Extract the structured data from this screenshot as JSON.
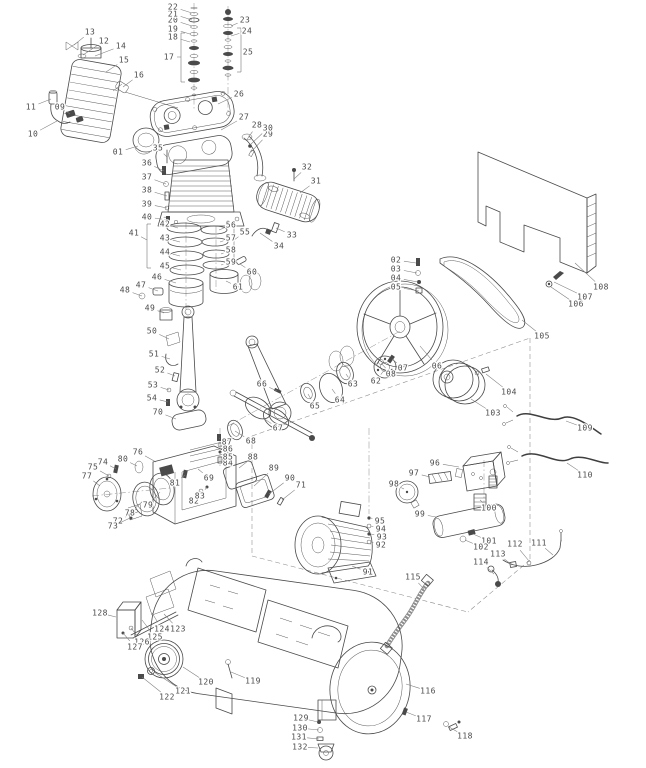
{
  "figure": {
    "type": "exploded-parts-diagram",
    "subject": "belt-driven air compressor assembly",
    "background_color": "#ffffff",
    "line_color": "#4a4a4a",
    "label_color": "#4a4a4a"
  },
  "labels": [
    {
      "n": "01",
      "x": 118,
      "y": 152,
      "tx": 138,
      "ty": 146
    },
    {
      "n": "02",
      "x": 396,
      "y": 260,
      "tx": 416,
      "ty": 263
    },
    {
      "n": "03",
      "x": 396,
      "y": 269,
      "tx": 417,
      "ty": 273
    },
    {
      "n": "04",
      "x": 396,
      "y": 278,
      "tx": 418,
      "ty": 282
    },
    {
      "n": "05",
      "x": 396,
      "y": 287,
      "tx": 419,
      "ty": 291
    },
    {
      "n": "06",
      "x": 437,
      "y": 366,
      "tx": 420,
      "ty": 346
    },
    {
      "n": "07",
      "x": 403,
      "y": 368,
      "tx": 392,
      "ty": 359
    },
    {
      "n": "08",
      "x": 391,
      "y": 374,
      "tx": 381,
      "ty": 363
    },
    {
      "n": "09",
      "x": 60,
      "y": 107,
      "tx": 70,
      "ty": 114
    },
    {
      "n": "10",
      "x": 33,
      "y": 134,
      "tx": 57,
      "ty": 121
    },
    {
      "n": "11",
      "x": 31,
      "y": 107,
      "tx": 51,
      "ty": 99
    },
    {
      "n": "12",
      "x": 104,
      "y": 41,
      "tx": 83,
      "ty": 55
    },
    {
      "n": "13",
      "x": 90,
      "y": 32,
      "tx": 74,
      "ty": 45
    },
    {
      "n": "14",
      "x": 121,
      "y": 46,
      "tx": 95,
      "ty": 56
    },
    {
      "n": "15",
      "x": 124,
      "y": 60,
      "tx": 106,
      "ty": 72
    },
    {
      "n": "16",
      "x": 139,
      "y": 75,
      "tx": 123,
      "ty": 87
    },
    {
      "n": "17",
      "x": 169,
      "y": 57,
      "tx": 181,
      "ty": 57
    },
    {
      "n": "18",
      "x": 173,
      "y": 37,
      "tx": 190,
      "ty": 42
    },
    {
      "n": "19",
      "x": 173,
      "y": 29,
      "tx": 190,
      "ty": 34
    },
    {
      "n": "20",
      "x": 173,
      "y": 20,
      "tx": 192,
      "ty": 26
    },
    {
      "n": "21",
      "x": 173,
      "y": 14,
      "tx": 192,
      "ty": 20
    },
    {
      "n": "22",
      "x": 173,
      "y": 7,
      "tx": 192,
      "ty": 13
    },
    {
      "n": "23",
      "x": 245,
      "y": 20,
      "tx": 231,
      "ty": 26
    },
    {
      "n": "24",
      "x": 247,
      "y": 31,
      "tx": 231,
      "ty": 36
    },
    {
      "n": "25",
      "x": 248,
      "y": 52,
      "tx": 241,
      "ty": 52
    },
    {
      "n": "26",
      "x": 239,
      "y": 94,
      "tx": 218,
      "ty": 104
    },
    {
      "n": "27",
      "x": 244,
      "y": 117,
      "tx": 221,
      "ty": 130
    },
    {
      "n": "28",
      "x": 257,
      "y": 125,
      "tx": 246,
      "ty": 141
    },
    {
      "n": "29",
      "x": 268,
      "y": 134,
      "tx": 251,
      "ty": 152
    },
    {
      "n": "30",
      "x": 268,
      "y": 128,
      "tx": 250,
      "ty": 145
    },
    {
      "n": "31",
      "x": 316,
      "y": 181,
      "tx": 300,
      "ty": 193
    },
    {
      "n": "32",
      "x": 307,
      "y": 167,
      "tx": 294,
      "ty": 179
    },
    {
      "n": "33",
      "x": 292,
      "y": 235,
      "tx": 276,
      "ty": 228
    },
    {
      "n": "34",
      "x": 279,
      "y": 246,
      "tx": 260,
      "ty": 233
    },
    {
      "n": "35",
      "x": 158,
      "y": 148,
      "tx": 167,
      "ty": 157
    },
    {
      "n": "36",
      "x": 147,
      "y": 163,
      "tx": 164,
      "ty": 171
    },
    {
      "n": "37",
      "x": 147,
      "y": 177,
      "tx": 166,
      "ty": 184
    },
    {
      "n": "38",
      "x": 147,
      "y": 190,
      "tx": 167,
      "ty": 196
    },
    {
      "n": "39",
      "x": 147,
      "y": 204,
      "tx": 167,
      "ty": 208
    },
    {
      "n": "40",
      "x": 147,
      "y": 217,
      "tx": 168,
      "ty": 220
    },
    {
      "n": "41",
      "x": 134,
      "y": 233,
      "tx": 147,
      "ty": 240
    },
    {
      "n": "42",
      "x": 165,
      "y": 224,
      "tx": 178,
      "ty": 228
    },
    {
      "n": "43",
      "x": 165,
      "y": 238,
      "tx": 180,
      "ty": 242
    },
    {
      "n": "44",
      "x": 165,
      "y": 252,
      "tx": 180,
      "ty": 256
    },
    {
      "n": "45",
      "x": 165,
      "y": 266,
      "tx": 181,
      "ty": 270
    },
    {
      "n": "46",
      "x": 157,
      "y": 277,
      "tx": 176,
      "ty": 283
    },
    {
      "n": "47",
      "x": 141,
      "y": 285,
      "tx": 158,
      "ty": 291
    },
    {
      "n": "48",
      "x": 125,
      "y": 290,
      "tx": 142,
      "ty": 296
    },
    {
      "n": "49",
      "x": 150,
      "y": 308,
      "tx": 164,
      "ty": 313
    },
    {
      "n": "50",
      "x": 152,
      "y": 331,
      "tx": 169,
      "ty": 339
    },
    {
      "n": "51",
      "x": 154,
      "y": 354,
      "tx": 170,
      "ty": 359
    },
    {
      "n": "52",
      "x": 160,
      "y": 370,
      "tx": 175,
      "ty": 376
    },
    {
      "n": "53",
      "x": 153,
      "y": 385,
      "tx": 169,
      "ty": 390
    },
    {
      "n": "54",
      "x": 152,
      "y": 398,
      "tx": 168,
      "ty": 402
    },
    {
      "n": "55",
      "x": 245,
      "y": 232,
      "tx": 234,
      "ty": 240
    },
    {
      "n": "56",
      "x": 231,
      "y": 225,
      "tx": 219,
      "ty": 230
    },
    {
      "n": "57",
      "x": 231,
      "y": 238,
      "tx": 220,
      "ty": 242
    },
    {
      "n": "58",
      "x": 231,
      "y": 250,
      "tx": 221,
      "ty": 254
    },
    {
      "n": "59",
      "x": 231,
      "y": 262,
      "tx": 221,
      "ty": 265
    },
    {
      "n": "60",
      "x": 252,
      "y": 272,
      "tx": 240,
      "ty": 264
    },
    {
      "n": "61",
      "x": 238,
      "y": 287,
      "tx": 226,
      "ty": 281
    },
    {
      "n": "62",
      "x": 376,
      "y": 381,
      "tx": 385,
      "ty": 369
    },
    {
      "n": "63",
      "x": 353,
      "y": 384,
      "tx": 346,
      "ty": 374
    },
    {
      "n": "64",
      "x": 340,
      "y": 400,
      "tx": 332,
      "ty": 389
    },
    {
      "n": "65",
      "x": 315,
      "y": 406,
      "tx": 308,
      "ty": 394
    },
    {
      "n": "66",
      "x": 262,
      "y": 384,
      "tx": 277,
      "ty": 391
    },
    {
      "n": "67",
      "x": 278,
      "y": 428,
      "tx": 263,
      "ty": 418
    },
    {
      "n": "68",
      "x": 251,
      "y": 441,
      "tx": 235,
      "ty": 431
    },
    {
      "n": "69",
      "x": 209,
      "y": 478,
      "tx": 198,
      "ty": 469
    },
    {
      "n": "70",
      "x": 158,
      "y": 412,
      "tx": 176,
      "ty": 419
    },
    {
      "n": "71",
      "x": 301,
      "y": 485,
      "tx": 282,
      "ty": 500
    },
    {
      "n": "72",
      "x": 118,
      "y": 521,
      "tx": 134,
      "ty": 512
    },
    {
      "n": "73",
      "x": 113,
      "y": 526,
      "tx": 130,
      "ty": 518
    },
    {
      "n": "74",
      "x": 103,
      "y": 462,
      "tx": 116,
      "ty": 469
    },
    {
      "n": "75",
      "x": 93,
      "y": 467,
      "tx": 109,
      "ty": 476
    },
    {
      "n": "76",
      "x": 138,
      "y": 452,
      "tx": 156,
      "ty": 462
    },
    {
      "n": "77",
      "x": 87,
      "y": 476,
      "tx": 100,
      "ty": 486
    },
    {
      "n": "78",
      "x": 130,
      "y": 513,
      "tx": 143,
      "ty": 501
    },
    {
      "n": "79",
      "x": 148,
      "y": 505,
      "tx": 160,
      "ty": 492
    },
    {
      "n": "80",
      "x": 123,
      "y": 459,
      "tx": 137,
      "ty": 466
    },
    {
      "n": "81",
      "x": 175,
      "y": 483,
      "tx": 185,
      "ty": 475
    },
    {
      "n": "82",
      "x": 194,
      "y": 501,
      "tx": 201,
      "ty": 491
    },
    {
      "n": "83",
      "x": 200,
      "y": 496,
      "tx": 207,
      "ty": 487
    },
    {
      "n": "84",
      "x": 228,
      "y": 463,
      "tx": 220,
      "ty": 460
    },
    {
      "n": "85",
      "x": 228,
      "y": 457,
      "tx": 220,
      "ty": 452
    },
    {
      "n": "86",
      "x": 228,
      "y": 449,
      "tx": 220,
      "ty": 445
    },
    {
      "n": "87",
      "x": 227,
      "y": 442,
      "tx": 219,
      "ty": 438
    },
    {
      "n": "88",
      "x": 253,
      "y": 457,
      "tx": 239,
      "ty": 468
    },
    {
      "n": "89",
      "x": 274,
      "y": 468,
      "tx": 254,
      "ty": 486
    },
    {
      "n": "90",
      "x": 290,
      "y": 478,
      "tx": 269,
      "ty": 494
    },
    {
      "n": "91",
      "x": 368,
      "y": 572,
      "tx": 352,
      "ty": 566
    },
    {
      "n": "92",
      "x": 381,
      "y": 545,
      "tx": 371,
      "ty": 542
    },
    {
      "n": "93",
      "x": 382,
      "y": 537,
      "tx": 371,
      "ty": 534
    },
    {
      "n": "94",
      "x": 381,
      "y": 529,
      "tx": 371,
      "ty": 526
    },
    {
      "n": "95",
      "x": 380,
      "y": 521,
      "tx": 371,
      "ty": 518
    },
    {
      "n": "96",
      "x": 435,
      "y": 463,
      "tx": 459,
      "ty": 467
    },
    {
      "n": "97",
      "x": 414,
      "y": 473,
      "tx": 430,
      "ty": 477
    },
    {
      "n": "98",
      "x": 394,
      "y": 484,
      "tx": 404,
      "ty": 489
    },
    {
      "n": "99",
      "x": 420,
      "y": 514,
      "tx": 436,
      "ty": 517
    },
    {
      "n": "100",
      "x": 489,
      "y": 508,
      "tx": 480,
      "ty": 500
    },
    {
      "n": "101",
      "x": 489,
      "y": 541,
      "tx": 473,
      "ty": 534
    },
    {
      "n": "102",
      "x": 481,
      "y": 547,
      "tx": 465,
      "ty": 540
    },
    {
      "n": "103",
      "x": 493,
      "y": 413,
      "tx": 471,
      "ty": 399
    },
    {
      "n": "104",
      "x": 509,
      "y": 392,
      "tx": 486,
      "ty": 374
    },
    {
      "n": "105",
      "x": 542,
      "y": 336,
      "tx": 522,
      "ty": 320
    },
    {
      "n": "106",
      "x": 576,
      "y": 304,
      "tx": 551,
      "ty": 287
    },
    {
      "n": "107",
      "x": 585,
      "y": 297,
      "tx": 554,
      "ty": 282
    },
    {
      "n": "108",
      "x": 601,
      "y": 287,
      "tx": 575,
      "ty": 263
    },
    {
      "n": "109",
      "x": 585,
      "y": 428,
      "tx": 566,
      "ty": 421
    },
    {
      "n": "110",
      "x": 585,
      "y": 475,
      "tx": 567,
      "ty": 463
    },
    {
      "n": "111",
      "x": 539,
      "y": 543,
      "tx": 553,
      "ty": 555
    },
    {
      "n": "112",
      "x": 515,
      "y": 544,
      "tx": 529,
      "ty": 561
    },
    {
      "n": "113",
      "x": 498,
      "y": 554,
      "tx": 512,
      "ty": 565
    },
    {
      "n": "114",
      "x": 481,
      "y": 562,
      "tx": 494,
      "ty": 574
    },
    {
      "n": "115",
      "x": 413,
      "y": 577,
      "tx": 424,
      "ty": 589
    },
    {
      "n": "116",
      "x": 428,
      "y": 691,
      "tx": 406,
      "ty": 684
    },
    {
      "n": "117",
      "x": 424,
      "y": 719,
      "tx": 406,
      "ty": 712
    },
    {
      "n": "118",
      "x": 465,
      "y": 736,
      "tx": 449,
      "ty": 727
    },
    {
      "n": "119",
      "x": 253,
      "y": 681,
      "tx": 231,
      "ty": 672
    },
    {
      "n": "120",
      "x": 206,
      "y": 682,
      "tx": 183,
      "ty": 667
    },
    {
      "n": "121",
      "x": 183,
      "y": 691,
      "tx": 154,
      "ty": 672
    },
    {
      "n": "122",
      "x": 167,
      "y": 697,
      "tx": 142,
      "ty": 677
    },
    {
      "n": "123",
      "x": 178,
      "y": 629,
      "tx": 164,
      "ty": 614
    },
    {
      "n": "124",
      "x": 162,
      "y": 629,
      "tx": 152,
      "ty": 613
    },
    {
      "n": "125",
      "x": 155,
      "y": 637,
      "tx": 142,
      "ty": 620
    },
    {
      "n": "126",
      "x": 142,
      "y": 642,
      "tx": 131,
      "ty": 628
    },
    {
      "n": "127",
      "x": 135,
      "y": 647,
      "tx": 123,
      "ty": 633
    },
    {
      "n": "128",
      "x": 100,
      "y": 613,
      "tx": 116,
      "ty": 617
    },
    {
      "n": "129",
      "x": 301,
      "y": 718,
      "tx": 318,
      "ty": 722
    },
    {
      "n": "130",
      "x": 300,
      "y": 728,
      "tx": 319,
      "ty": 730
    },
    {
      "n": "131",
      "x": 299,
      "y": 737,
      "tx": 319,
      "ty": 739
    },
    {
      "n": "132",
      "x": 300,
      "y": 747,
      "tx": 318,
      "ty": 748
    }
  ]
}
